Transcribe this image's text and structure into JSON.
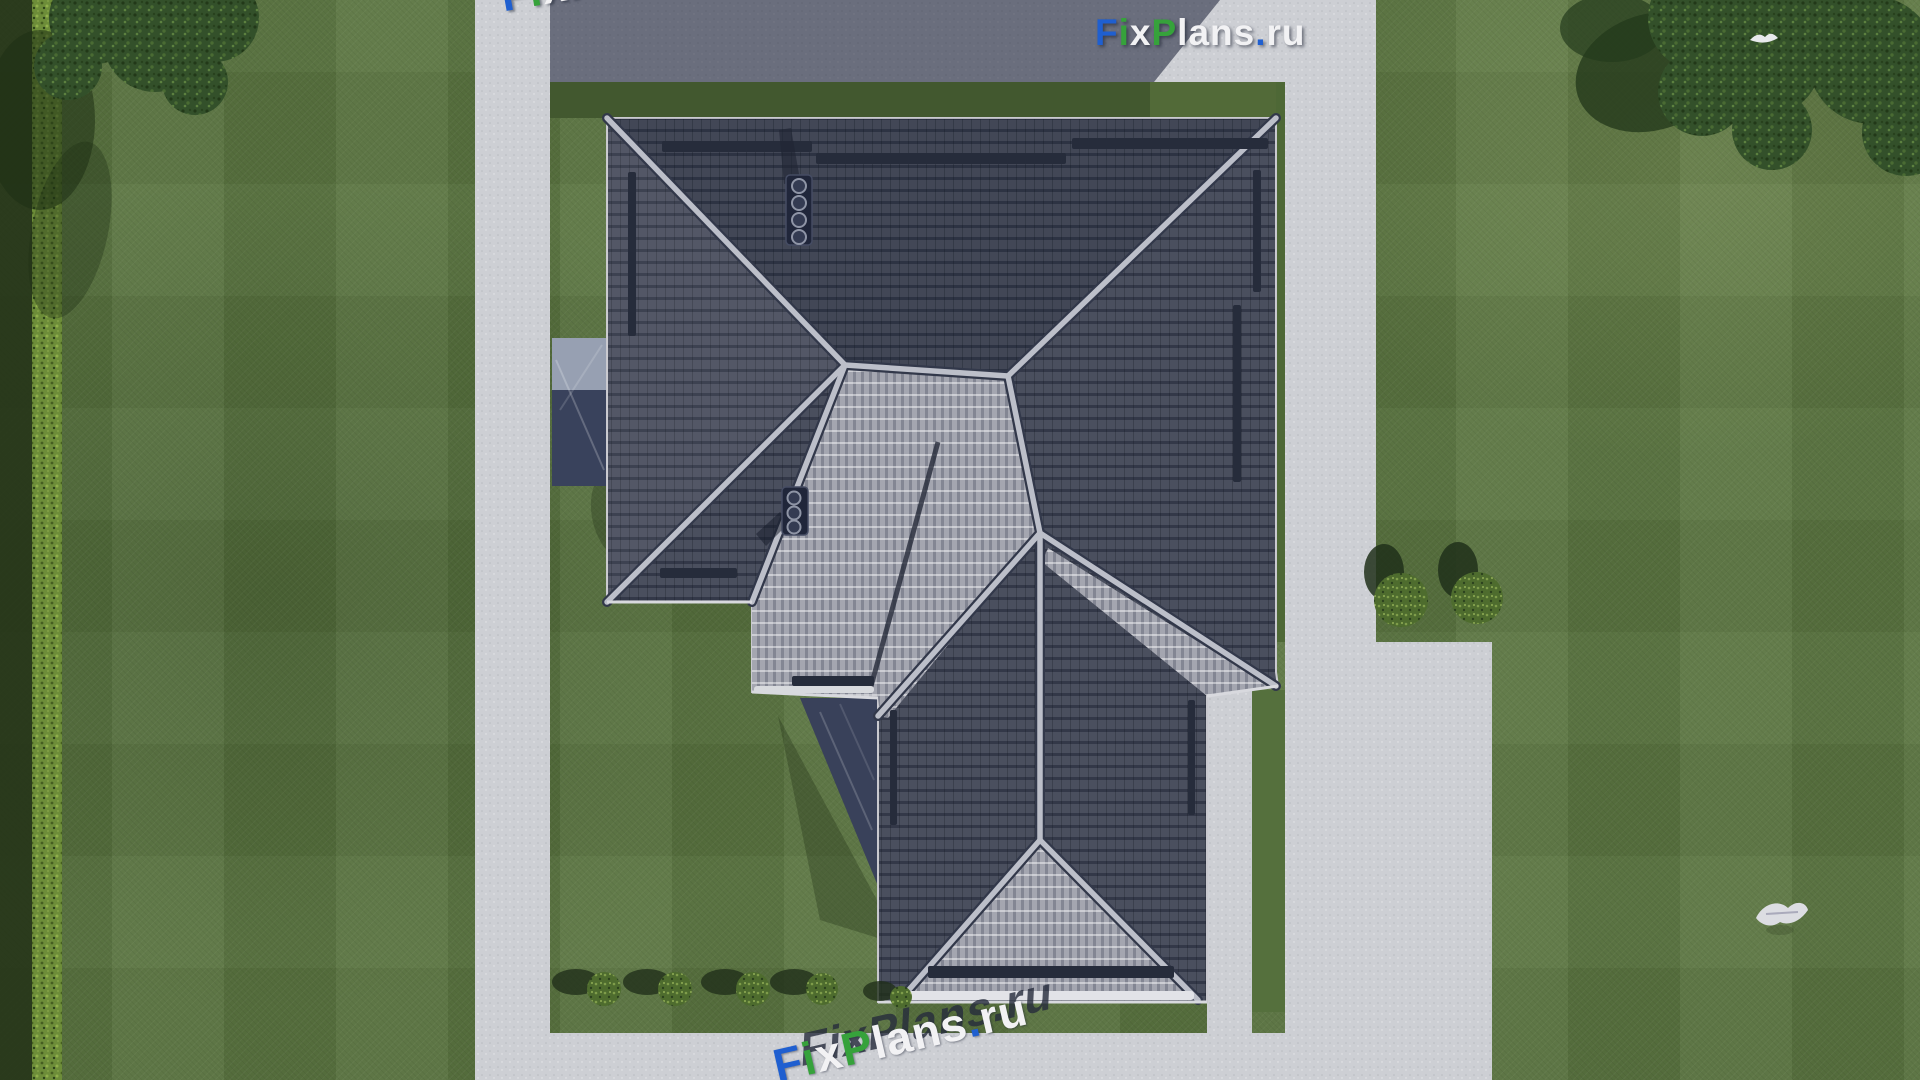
{
  "branding": {
    "logo_text": "FixPlans.ru",
    "logo_letters": [
      {
        "ch": "F",
        "color": "#1f5fd0"
      },
      {
        "ch": "i",
        "color": "#36a23b"
      },
      {
        "ch": "x",
        "color": "#f2f2f4"
      },
      {
        "ch": "P",
        "color": "#36a23b"
      },
      {
        "ch": "l",
        "color": "#f2f2f4"
      },
      {
        "ch": "a",
        "color": "#f2f2f4"
      },
      {
        "ch": "n",
        "color": "#f2f2f4"
      },
      {
        "ch": "s",
        "color": "#f2f2f4"
      },
      {
        "ch": ".",
        "color": "#1f5fd0"
      },
      {
        "ch": "r",
        "color": "#f2f2f4"
      },
      {
        "ch": "u",
        "color": "#f2f2f4"
      }
    ]
  },
  "watermarks": {
    "top_edge": {
      "text": "FixPlans.ru",
      "rotation_deg": -10
    },
    "bottom_path": {
      "text": "FixPlans.ru",
      "rotation_deg": -13
    }
  },
  "scene": {
    "view": "aerial top-down render of hip-roof house with yard",
    "roof_tile_dark": "#4a4f5e",
    "roof_tile_light": "#a4a6b0",
    "ridge_cap": "#bcbfc9",
    "lawn_green": "#5b7541",
    "pavement": "#cdcfd4",
    "shadow_pavement": "#5d6272",
    "hedge_green": "#6d8d39",
    "chimney_count": 2,
    "bottom_bush_count": 5,
    "side_bush_count": 2,
    "bird_count": 2
  }
}
